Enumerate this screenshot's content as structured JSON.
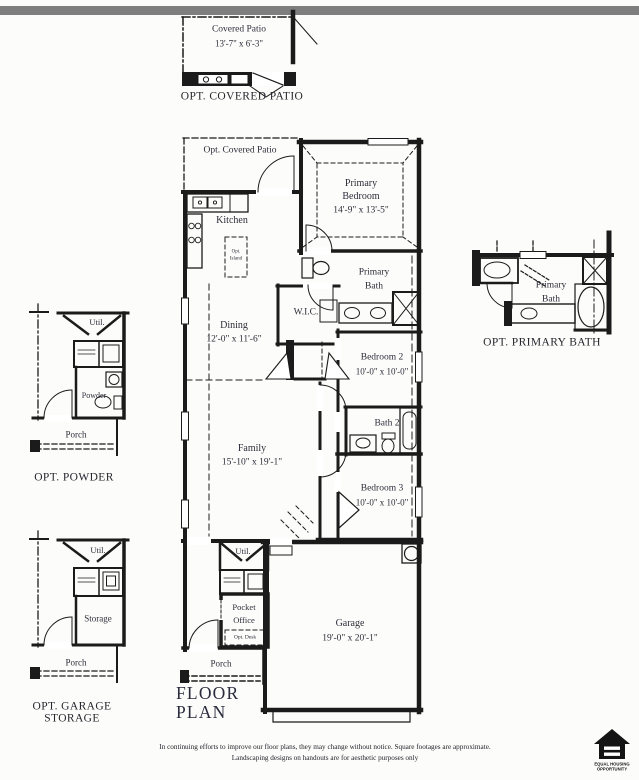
{
  "sheet": {
    "title_line1": "FLOOR",
    "title_line2": "PLAN",
    "disclaimer_line1": "In continuing efforts to improve our floor plans, they may change without notice. Square footages are approximate.",
    "disclaimer_line2": "Landscaping designs on handouts are for aesthetic purposes only"
  },
  "colors": {
    "ink": "#1b1b1b",
    "label": "#2d2d3a",
    "top_bar": "#7e7e7e",
    "background": "#fcfcfa"
  },
  "insets": {
    "covered_patio": {
      "caption": "OPT. COVERED PATIO",
      "room_name": "Covered Patio",
      "room_dims": "13'-7\" x 6'-3\""
    },
    "powder": {
      "caption": "OPT. POWDER",
      "util": "Util.",
      "powder": "Powder",
      "porch": "Porch"
    },
    "garage_storage": {
      "caption_line1": "OPT. GARAGE",
      "caption_line2": "STORAGE",
      "util": "Util.",
      "storage": "Storage",
      "porch": "Porch"
    },
    "primary_bath": {
      "caption": "OPT. PRIMARY BATH",
      "name_line1": "Primary",
      "name_line2": "Bath"
    }
  },
  "main": {
    "opt_covered_patio": "Opt. Covered Patio",
    "kitchen": "Kitchen",
    "island_line1": "Opt.",
    "island_line2": "Island",
    "primary_bedroom_line1": "Primary",
    "primary_bedroom_line2": "Bedroom",
    "primary_bedroom_dims": "14'-9\" x 13'-5\"",
    "primary_bath_line1": "Primary",
    "primary_bath_line2": "Bath",
    "wic": "W.I.C.",
    "dining": "Dining",
    "dining_dims": "12'-0\" x 11'-6\"",
    "bedroom2": "Bedroom 2",
    "bedroom2_dims": "10'-0\" x 10'-0\"",
    "bath2": "Bath 2",
    "family": "Family",
    "family_dims": "15'-10\" x 19'-1\"",
    "bedroom3": "Bedroom 3",
    "bedroom3_dims": "10'-0\" x 10'-0\"",
    "util": "Util.",
    "pocket_office_line1": "Pocket",
    "pocket_office_line2": "Office",
    "opt_desk": "Opt. Desk",
    "garage": "Garage",
    "garage_dims": "19'-0\" x 20'-1\"",
    "porch": "Porch"
  },
  "logo": {
    "line1": "EQUAL HOUSING",
    "line2": "OPPORTUNITY"
  }
}
